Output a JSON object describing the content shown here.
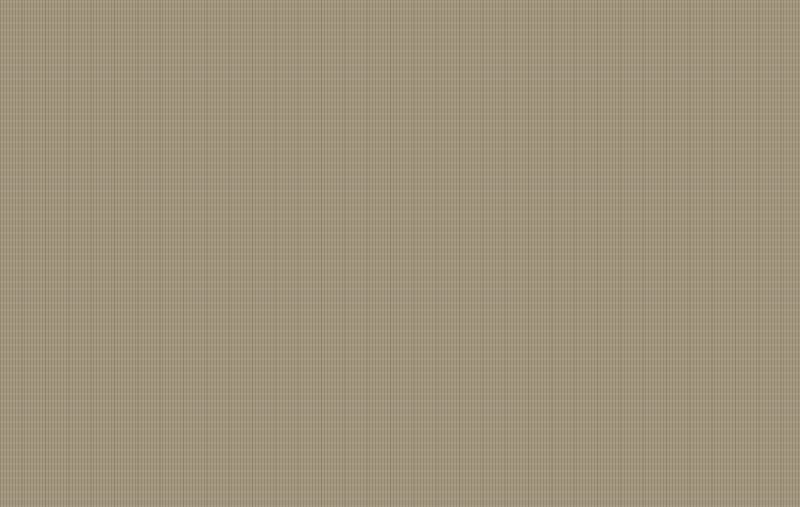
{
  "logo": {
    "brand": "SEEWIN",
    "cn": "诗敏",
    "color": "#14489c"
  },
  "palette": {
    "bg": "#ebebeb",
    "floor": "#a4977f",
    "terrace": "#d1d1cf",
    "wall_line": "#504e49",
    "column": "#262626",
    "chair_white": "#f2f1ee",
    "chair_white_border": "#adaaa2",
    "chair_green": "#93a47c",
    "chair_green_border": "#6b7b55",
    "planter_green": "#57703b",
    "spine": "#dbdad4",
    "table": "#f3f2ef",
    "logo_blue": "#14489c",
    "rim_line": "#454440"
  },
  "floor_polygon": [
    [
      152,
      95
    ],
    [
      683,
      95
    ],
    [
      683,
      79
    ],
    [
      737,
      79
    ],
    [
      737,
      93
    ],
    [
      781,
      93
    ],
    [
      781,
      219
    ],
    [
      628,
      219
    ],
    [
      628,
      284
    ],
    [
      315,
      284
    ],
    [
      315,
      346
    ],
    [
      195,
      346
    ],
    [
      195,
      379
    ],
    [
      83,
      306
    ],
    [
      83,
      222
    ],
    [
      12,
      222
    ],
    [
      12,
      152
    ],
    [
      152,
      152
    ]
  ],
  "terrace_polygon": [
    [
      195,
      348
    ],
    [
      315,
      348
    ],
    [
      315,
      287
    ],
    [
      628,
      287
    ],
    [
      628,
      221
    ],
    [
      786,
      221
    ],
    [
      800,
      247
    ],
    [
      800,
      261
    ],
    [
      717,
      271
    ],
    [
      672,
      299
    ],
    [
      627,
      327
    ],
    [
      578,
      356
    ],
    [
      528,
      381
    ],
    [
      478,
      399
    ],
    [
      428,
      412
    ],
    [
      383,
      419
    ],
    [
      338,
      421
    ],
    [
      293,
      415
    ],
    [
      248,
      402
    ],
    [
      215,
      391
    ],
    [
      196,
      381
    ]
  ],
  "rim_path": "M196,381 C250,406 320,423 383,420 C450,417 520,394 585,352 C640,317 692,286 717,271 L800,261 M786,221 L800,247",
  "diagonal_wall": {
    "x1": 80,
    "y1": 303,
    "x2": 197,
    "y2": 378
  },
  "walls": [
    [
      148,
      91,
      539,
      9
    ],
    [
      679,
      73,
      8,
      22
    ],
    [
      679,
      73,
      61,
      7
    ],
    [
      731,
      73,
      8,
      22
    ],
    [
      736,
      89,
      47,
      9
    ],
    [
      777,
      93,
      9,
      45
    ],
    [
      777,
      166,
      9,
      53
    ],
    [
      5,
      146,
      147,
      8
    ],
    [
      5,
      146,
      9,
      78
    ],
    [
      5,
      215,
      78,
      9
    ],
    [
      74,
      244,
      9,
      60
    ],
    [
      188,
      340,
      129,
      9
    ],
    [
      308,
      282,
      9,
      62
    ],
    [
      313,
      277,
      19,
      9
    ],
    [
      374,
      277,
      256,
      9
    ],
    [
      623,
      216,
      9,
      66
    ],
    [
      626,
      212,
      158,
      9
    ]
  ],
  "columns": [
    [
      181,
      86,
      16,
      15
    ],
    [
      303,
      86,
      16,
      15
    ],
    [
      428,
      86,
      16,
      15
    ],
    [
      558,
      86,
      16,
      15
    ],
    [
      676,
      84,
      15,
      15
    ],
    [
      728,
      83,
      17,
      17
    ],
    [
      773,
      91,
      15,
      14
    ],
    [
      5,
      143,
      14,
      14
    ],
    [
      138,
      141,
      15,
      14
    ],
    [
      5,
      212,
      14,
      14
    ],
    [
      73,
      210,
      15,
      38
    ],
    [
      72,
      293,
      15,
      17
    ],
    [
      181,
      210,
      16,
      16
    ],
    [
      233,
      213,
      14,
      28
    ],
    [
      305,
      213,
      14,
      14
    ],
    [
      427,
      210,
      16,
      16
    ],
    [
      557,
      210,
      16,
      16
    ],
    [
      126,
      339,
      12,
      11
    ],
    [
      183,
      336,
      15,
      15
    ],
    [
      305,
      336,
      15,
      15
    ],
    [
      305,
      275,
      15,
      15
    ],
    [
      428,
      271,
      15,
      15
    ],
    [
      558,
      271,
      15,
      15
    ],
    [
      617,
      273,
      13,
      13
    ],
    [
      620,
      210,
      14,
      14
    ],
    [
      679,
      211,
      15,
      15
    ],
    [
      771,
      209,
      17,
      16
    ]
  ],
  "balconies": [
    [
      312,
      81,
      254,
      14
    ],
    [
      740,
      82,
      58,
      14
    ]
  ],
  "shaft": {
    "outer": [
      122,
      76,
      17,
      52
    ],
    "inner": [
      138,
      76,
      18,
      52
    ],
    "knobs": [
      [
        146,
        90
      ],
      [
        146,
        106
      ]
    ]
  },
  "doors": [
    {
      "rect": [
        778,
        136,
        22,
        33
      ],
      "arcs": "M797,140 Q784,143 783,153 M797,165 Q784,162 783,153"
    },
    {
      "rect": [
        330,
        278,
        46,
        31
      ],
      "arcs": "M333,285 Q352,288 353,308 M373,285 Q354,288 353,308"
    },
    {
      "rect": [
        137,
        124,
        17,
        25
      ],
      "arcs": "M140,128 Q152,131 153,146"
    }
  ],
  "clusters_v": [
    {
      "x": 18,
      "y": 151,
      "h": 38,
      "n": 4,
      "pitch": 9.6,
      "chairW": 12,
      "chairH": 8,
      "spineW": 13,
      "right": "g",
      "planter": null
    },
    {
      "x": 71,
      "y": 151,
      "h": 38,
      "n": 4,
      "pitch": 9.6,
      "chairW": 12,
      "chairH": 8,
      "spineW": 13,
      "right": "g",
      "planter": null
    },
    {
      "x": 124,
      "y": 151,
      "h": 38,
      "n": 4,
      "pitch": 9.6,
      "chairW": 12,
      "chairH": 8,
      "spineW": 13,
      "right": "g",
      "planter": null
    },
    {
      "x": 177,
      "y": 151,
      "h": 38,
      "n": 4,
      "pitch": 9.6,
      "chairW": 12,
      "chairH": 8,
      "spineW": 13,
      "right": "g",
      "planter": null
    },
    {
      "x": 72,
      "y": 228,
      "h": 88,
      "n": 7,
      "pitch": 12.3,
      "chairW": 12,
      "chairH": 10,
      "spineW": 22,
      "right": "g",
      "planter": [
        72,
        222,
        49,
        5
      ]
    },
    {
      "x": 125,
      "y": 228,
      "h": 88,
      "n": 7,
      "pitch": 12.3,
      "chairW": 12,
      "chairH": 10,
      "spineW": 22,
      "right": "g",
      "planter": [
        125,
        222,
        49,
        5
      ]
    },
    {
      "x": 178,
      "y": 228,
      "h": 88,
      "n": 7,
      "pitch": 12.3,
      "chairW": 12,
      "chairH": 10,
      "spineW": 22,
      "right": "g",
      "planter": [
        178,
        222,
        49,
        5
      ]
    },
    {
      "x": 231,
      "y": 228,
      "h": 88,
      "n": 7,
      "pitch": 12.3,
      "chairW": 12,
      "chairH": 10,
      "spineW": 22,
      "right": "g",
      "planter": [
        231,
        222,
        49,
        5
      ]
    },
    {
      "x": 273,
      "y": 228,
      "h": 88,
      "n": 7,
      "pitch": 12.3,
      "chairW": 12,
      "chairH": 10,
      "spineW": 21,
      "right": null,
      "planter": [
        273,
        222,
        36,
        5
      ]
    },
    {
      "x": 378,
      "y": 162,
      "h": 90,
      "n": 8,
      "pitch": 11,
      "chairW": 12,
      "chairH": 10,
      "spineW": 13,
      "right": "g",
      "planter": [
        377,
        154,
        40,
        5
      ]
    },
    {
      "x": 420,
      "y": 162,
      "h": 90,
      "n": 8,
      "pitch": 11,
      "chairW": 12,
      "chairH": 10,
      "spineW": 13,
      "right": "g",
      "planter": [
        419,
        154,
        40,
        5
      ]
    },
    {
      "x": 462,
      "y": 162,
      "h": 90,
      "n": 8,
      "pitch": 11,
      "chairW": 12,
      "chairH": 10,
      "spineW": 13,
      "right": "g",
      "planter": [
        461,
        154,
        40,
        5
      ]
    },
    {
      "x": 504,
      "y": 162,
      "h": 90,
      "n": 8,
      "pitch": 11,
      "chairW": 12,
      "chairH": 10,
      "spineW": 13,
      "right": "g",
      "planter": [
        503,
        154,
        40,
        5
      ]
    },
    {
      "x": 546,
      "y": 162,
      "h": 90,
      "n": 8,
      "pitch": 11,
      "chairW": 12,
      "chairH": 10,
      "spineW": 13,
      "right": "g",
      "planter": [
        545,
        154,
        40,
        5
      ]
    },
    {
      "x": 586,
      "y": 162,
      "h": 90,
      "n": 8,
      "pitch": 11,
      "chairW": 12,
      "chairH": 10,
      "spineW": 13,
      "right": "g",
      "planter": [
        585,
        154,
        38,
        5
      ]
    },
    {
      "x": 677,
      "y": 158,
      "h": 55,
      "n": 5,
      "pitch": 11,
      "chairW": 13,
      "chairH": 9,
      "spineW": 14,
      "right": "g",
      "planter": null
    }
  ],
  "clusters_h": [
    {
      "x": 238,
      "y": 166,
      "n": 3,
      "pitch": 12.5,
      "chairW": 11,
      "chairH": 10,
      "spine": [
        236,
        178,
        36,
        9
      ],
      "planter": [
        238,
        158,
        32,
        5
      ]
    },
    {
      "x": 287,
      "y": 165,
      "n": 3,
      "pitch": 12.5,
      "chairW": 11,
      "chairH": 10,
      "spine": [
        285,
        177,
        38,
        9
      ],
      "planter": [
        287,
        157,
        33,
        5
      ]
    },
    {
      "x": 626,
      "y": 165,
      "n": 4,
      "pitch": 12,
      "chairW": 11,
      "chairH": 10,
      "spine": [
        623,
        177,
        50,
        9
      ],
      "planter": [
        625,
        158,
        46,
        5
      ]
    },
    {
      "x": 719,
      "y": 165,
      "n": 4,
      "pitch": 12,
      "chairW": 11,
      "chairH": 10,
      "spine": [
        716,
        177,
        52,
        9
      ],
      "planter": [
        719,
        158,
        48,
        5
      ]
    }
  ],
  "chair_rows": [
    {
      "xs": [
        24,
        41,
        58,
        99,
        116,
        133,
        150,
        166,
        200,
        216,
        252,
        268,
        284,
        300
      ],
      "y": 201,
      "w": 12,
      "h": 10
    },
    {
      "x": 384,
      "n": 15,
      "pitch": 16,
      "y": 263,
      "w": 12,
      "h": 11
    },
    {
      "xs": [
        626,
        641,
        656,
        671,
        692,
        718,
        733,
        748,
        763
      ],
      "y": 202,
      "w": 12,
      "h": 10
    }
  ],
  "bands": [
    [
      20,
      212,
      57,
      8
    ],
    [
      95,
      212,
      86,
      8
    ],
    [
      198,
      212,
      36,
      8
    ],
    [
      252,
      212,
      54,
      8
    ]
  ],
  "tables": [
    [
      316,
      303,
      28,
      24
    ],
    [
      165,
      329,
      17,
      49
    ]
  ],
  "chairs_extra": [
    {
      "x": 317,
      "y": 291,
      "c": "w"
    },
    {
      "x": 331,
      "y": 291,
      "c": "w"
    },
    {
      "x": 317,
      "y": 330,
      "c": "g"
    },
    {
      "x": 331,
      "y": 330,
      "c": "g"
    },
    {
      "x": 152,
      "y": 332,
      "c": "g"
    },
    {
      "x": 152,
      "y": 347,
      "c": "g"
    },
    {
      "x": 152,
      "y": 362,
      "c": "g"
    }
  ],
  "smile_path": "M688,478 Q711,487 733,477",
  "logo_pos": {
    "x": 643,
    "y": 448
  }
}
